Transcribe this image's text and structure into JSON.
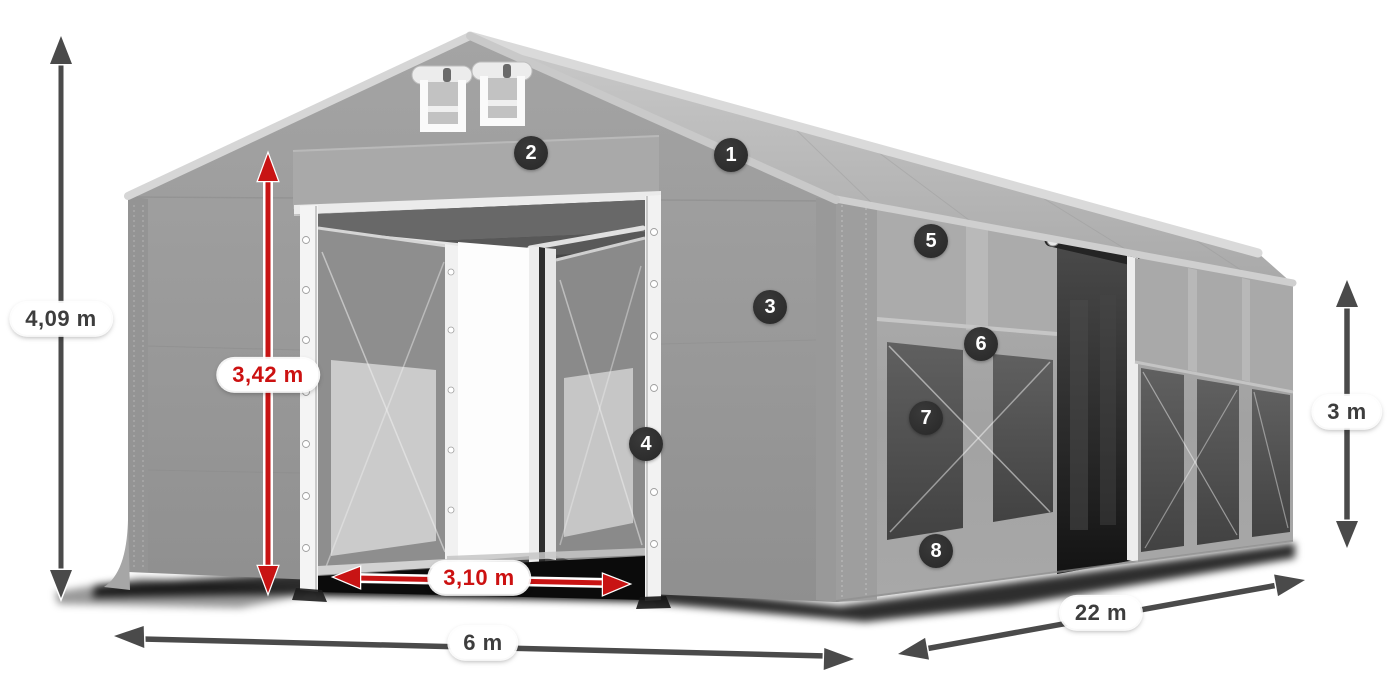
{
  "figure": {
    "type": "product-diagram",
    "subject": "Gray gabled storage tent 3D render with open double front entrance, two rolled gable vents, open side bay and windowed side walls",
    "background": "#ffffff"
  },
  "colors": {
    "dimension_red": "#c81414",
    "dimension_gray": "#4a4a4a",
    "pill_bg": "#ffffff",
    "badge_bg": "#2d2d2d",
    "badge_text": "#ffffff",
    "tent_gray": "#9b9b9b"
  },
  "dimensions": [
    {
      "id": "total-height",
      "label": "4,09 m",
      "style": "gray",
      "orientation": "vertical"
    },
    {
      "id": "entrance-height",
      "label": "3,42 m",
      "style": "red",
      "orientation": "vertical"
    },
    {
      "id": "entrance-width",
      "label": "3,10 m",
      "style": "red",
      "orientation": "horizontal"
    },
    {
      "id": "front-width",
      "label": "6 m",
      "style": "gray",
      "orientation": "horizontal"
    },
    {
      "id": "side-length",
      "label": "22 m",
      "style": "gray",
      "orientation": "diagonal"
    },
    {
      "id": "side-height",
      "label": "3 m",
      "style": "gray",
      "orientation": "vertical"
    }
  ],
  "hotspots": [
    {
      "number": "1"
    },
    {
      "number": "2"
    },
    {
      "number": "3"
    },
    {
      "number": "4"
    },
    {
      "number": "5"
    },
    {
      "number": "6"
    },
    {
      "number": "7"
    },
    {
      "number": "8"
    }
  ]
}
